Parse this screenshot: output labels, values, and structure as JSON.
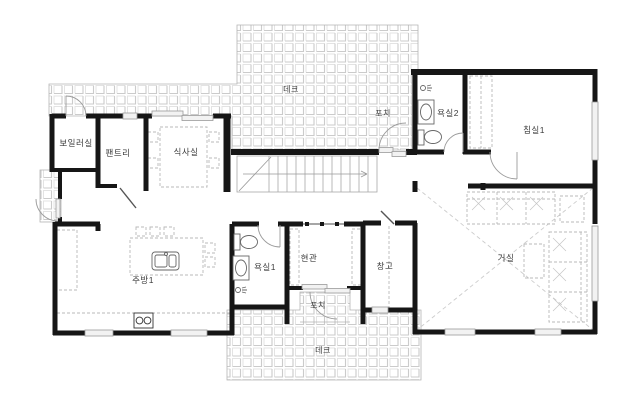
{
  "plan": {
    "kind": "residential-floor-plan",
    "language": "ko",
    "labels": {
      "deck_top": "데크",
      "porch_top": "포치",
      "boiler_room": "보일러실",
      "pantry": "팬트리",
      "dining_room": "식사실",
      "bathroom2": "욕실2",
      "bedroom1": "침실1",
      "kitchen1": "주방1",
      "bathroom1": "욕실1",
      "entrance": "현관",
      "storage": "창고",
      "living_room": "거실",
      "porch_bottom": "포치",
      "deck_bottom": "데크"
    },
    "fixtures": [
      "staircase",
      "dining-table",
      "kitchen-island",
      "kitchen-sink-icon",
      "stove-icon",
      "toilet-icon",
      "washbasin-icon",
      "shower-icon",
      "sofa-icon",
      "coffee-table",
      "side-table",
      "wardrobe",
      "door-swing-icon",
      "sliding-door-icon",
      "window",
      "deck-tiles"
    ],
    "colors": {
      "wall": "#161616",
      "tile_line": "#d6d6d6",
      "window_frame": "#9a9a9a",
      "furniture_dash": "#b9b9b9",
      "stair_line": "#a8a8a8",
      "label": "#3c3c3c",
      "background": "#ffffff"
    }
  }
}
